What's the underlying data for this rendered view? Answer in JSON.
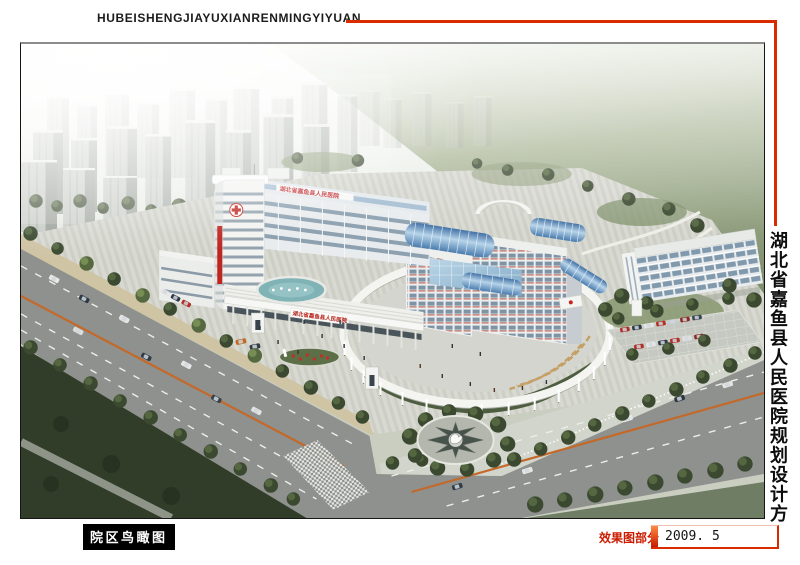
{
  "board": {
    "header": {
      "pinyin_title": "HUBEISHENGJIAYUXIANRENMINGYIYUAN"
    },
    "side_title": "湖北省嘉鱼县人民医院规划设计方案",
    "footer": {
      "view_caption": "院区鸟瞰图",
      "section_label": "效果图部分",
      "date": "2009. 5"
    },
    "rendering": {
      "building_sign": "湖北省嘉鱼县人民医院"
    },
    "colors": {
      "accent_red": "#d92b00",
      "section_red": "#cc1c00",
      "caption_bg": "#000000",
      "caption_text": "#ffffff",
      "glass_blue": "#5f93c8",
      "water_teal": "#7fb3b6",
      "plaza_gray": "#d6d7d0",
      "grass_dark": "#39452f",
      "field_green": "#8a9a78",
      "building_white": "#f2f3f1"
    }
  }
}
